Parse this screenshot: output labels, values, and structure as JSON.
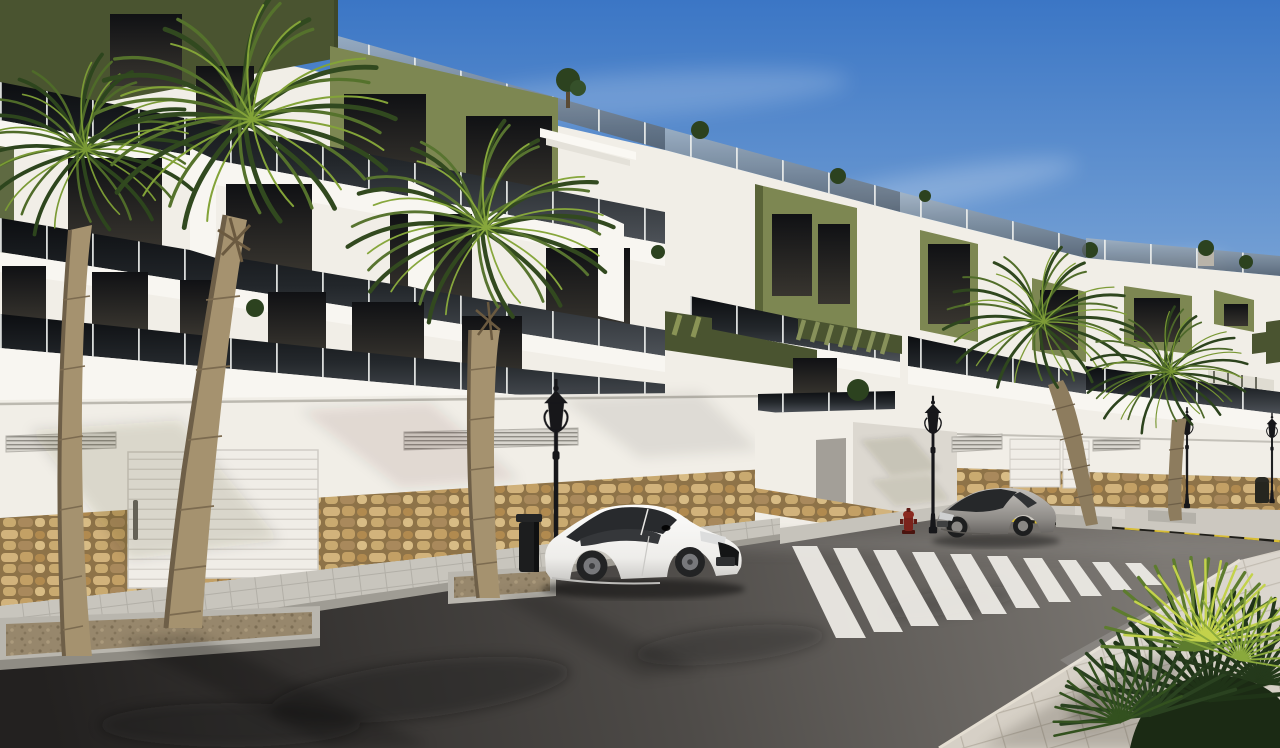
{
  "window": {
    "title": "New-build apartment complex — sunny street exterior render"
  },
  "scene": {
    "description": "Sunny 3D architectural render of a modern white apartment complex with olive-green accent facades, dark glass balcony railings and rooftop terraces stepping down along a curving street. Palm trees line the pavements, a white sports coupe and a silver hatchback are parked at the kerb, a zebra crossing spans the asphalt and a yellow-and-black painted no-parking kerb runs along the right side, with a fan-palm shrub in the near foreground.",
    "time_of_day": "day",
    "sky": {
      "condition": "clear blue with thin wispy cirrus clouds"
    },
    "buildings": [
      {
        "name": "left apartment block",
        "floors_visible": 3,
        "features": [
          "olive-green corner volume",
          "three tiers of dark glass balcony railings",
          "rooftop glass balustrade with plants",
          "white garage doors",
          "rubble-stone clad base wall",
          "louvered vent grilles"
        ]
      },
      {
        "name": "middle apartment block",
        "floors_visible": 3,
        "features": [
          "olive-green window surround boxes",
          "green slatted pergolas over terraces",
          "stepped white terraces",
          "corner terrace over street wall"
        ]
      },
      {
        "name": "right apartment block",
        "floors_visible": 2,
        "features": [
          "olive-green accent boxes",
          "rooftop planters with shrubs",
          "striped terrace awning",
          "stone-clad street wall with garage doors"
        ]
      }
    ],
    "street": {
      "elements": [
        "dark asphalt road",
        "zebra pedestrian crossing",
        "yellow-and-black painted no-parking kerb",
        "paved sidewalks",
        "palm planter islands",
        "driveway ramp"
      ],
      "furniture": [
        "four ornate black street lanterns",
        "two dark litter bins",
        "red fire hydrant"
      ]
    },
    "vehicles": [
      {
        "type": "white sports coupe",
        "position": "parked at the left kerb, facing right"
      },
      {
        "type": "silver hatchback coupe",
        "position": "parked at the far kerb beside the crossing"
      }
    ],
    "vegetation": [
      "two tall palms on the left pavement",
      "one palm beside the white coupe",
      "two leaning palms on the right pavement",
      "fan-palm shrub in the near foreground",
      "small shrubs on rooftops and balconies"
    ]
  },
  "palette": {
    "sky_top": "#3b76c5",
    "sky_mid": "#86add9",
    "sky_horizon": "#d3e2f0",
    "wall_white": "#f1eee7",
    "wall_shade": "#dcd8d0",
    "olive": "#7d8752",
    "olive_dark": "#4a5430",
    "glass_dark": "#15181c",
    "stone_tan": "#c3a169",
    "road_dark": "#2e2c2a",
    "sidewalk": "#cdc9c1",
    "crosswalk_white": "#eceae5",
    "curb_yellow": "#d8bd35",
    "palm_green": "#43602a",
    "palm_light": "#9cb844",
    "trunk_tan": "#a5926f",
    "car_white": "#f4f3f1",
    "car_silver": "#9b9894",
    "lamp_black": "#17171a",
    "hydrant_red": "#7a231c"
  }
}
